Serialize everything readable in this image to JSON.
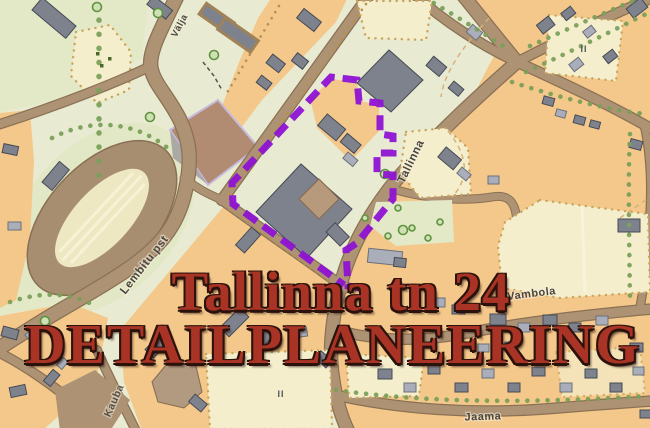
{
  "map": {
    "street_labels": {
      "valja": "Välja",
      "tallinna": "Tallinna",
      "lembitu_pst": "Lembitu pst",
      "kauba": "Kauba",
      "vambola": "Vambola",
      "jaama": "Jaama"
    },
    "symbols": {
      "building_mark": "II"
    }
  },
  "overlay": {
    "title_line1": "Tallinna tn 24",
    "title_line2": "DETAILPLANEERING",
    "title_color": "#a93426",
    "boundary_color": "#8e13d3"
  },
  "colors": {
    "background": "#e8ebd1",
    "residential_block": "#f4c88b",
    "road_fill": "#ad9274",
    "road_edge": "#8b7154",
    "building_dark": "#7e828d",
    "building_light": "#a9aeba",
    "parcel_pale": "#f4eecd",
    "tree_green": "#5f9340",
    "plowed_field": "#b18c72",
    "stadium_track": "#a88e71"
  }
}
